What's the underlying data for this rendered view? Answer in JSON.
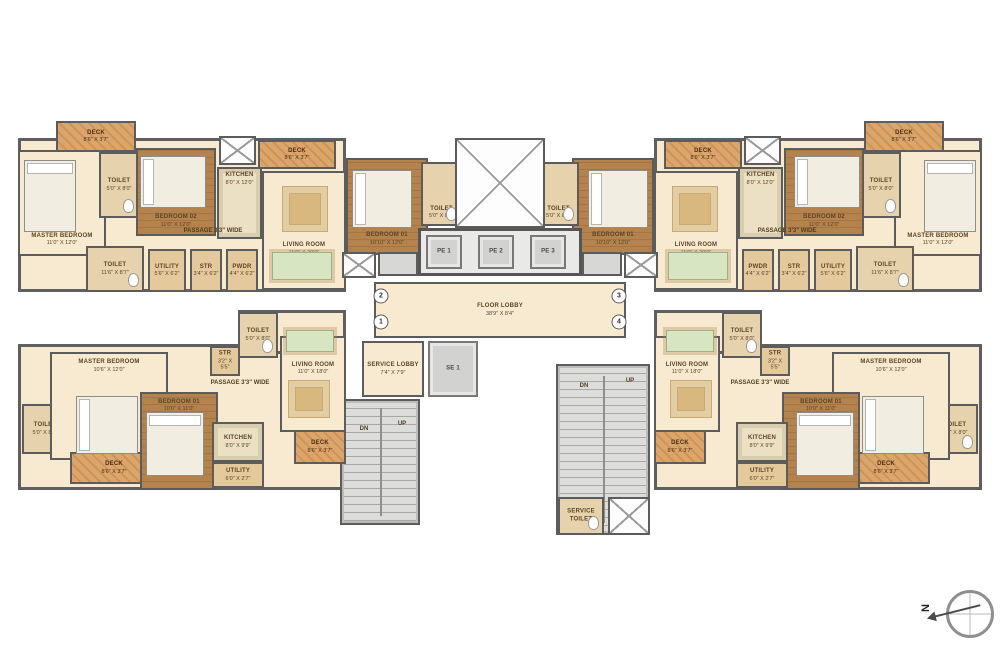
{
  "north": {
    "label": "N"
  },
  "colors": {
    "wall": "#5c5c5c",
    "floor_cream": "#f7ead0",
    "floor_wood": "#b3824d",
    "deck": "#dba56e",
    "kitchen": "#ece0c4",
    "toilet": "#e6d2ac",
    "utility": "#e4c99c",
    "stairs_gray": "#d7d7d5",
    "label_text": "#5e4526"
  },
  "rooms": [
    {
      "id": "unit-top-footprint",
      "label": "",
      "dims": "",
      "x": 18,
      "y": 138,
      "w": 328,
      "h": 154,
      "type": "base",
      "mirror": true
    },
    {
      "id": "unit-bottom-footprint",
      "label": "",
      "dims": "",
      "x": 18,
      "y": 344,
      "w": 328,
      "h": 146,
      "type": "base",
      "mirror": true
    },
    {
      "id": "unit-bottom-ext",
      "label": "",
      "dims": "",
      "x": 238,
      "y": 310,
      "w": 108,
      "h": 44,
      "type": "base",
      "mirror": true
    },
    {
      "id": "deck-top-outer",
      "label": "DECK",
      "dims": "8'6\" X 3'7\"",
      "x": 56,
      "y": 121,
      "w": 80,
      "h": 31,
      "type": "deck",
      "lp": "mid",
      "mirror": true
    },
    {
      "id": "master-bedroom-top",
      "label": "MASTER BEDROOM",
      "dims": "11'0\" X 12'0\"",
      "x": 18,
      "y": 150,
      "w": 88,
      "h": 106,
      "type": "cream",
      "lp": "bot",
      "mirror": true
    },
    {
      "id": "toilet-master-top",
      "label": "TOILET",
      "dims": "5'0\" X 8'0\"",
      "x": 99,
      "y": 152,
      "w": 40,
      "h": 66,
      "type": "toilet",
      "lp": "mid",
      "mirror": true
    },
    {
      "id": "bedroom-02-top",
      "label": "BEDROOM 02",
      "dims": "11'0\" X 12'0\"",
      "x": 136,
      "y": 148,
      "w": 80,
      "h": 88,
      "type": "wood",
      "lp": "bot",
      "mirror": true
    },
    {
      "id": "duct-top",
      "label": "",
      "dims": "",
      "x": 219,
      "y": 136,
      "w": 37,
      "h": 29,
      "type": "shaft",
      "mirror": true
    },
    {
      "id": "kitchen-top",
      "label": "KITCHEN",
      "dims": "8'0\" X 12'0\"",
      "x": 217,
      "y": 167,
      "w": 45,
      "h": 72,
      "type": "kitchen",
      "lp": "top",
      "mirror": true
    },
    {
      "id": "deck-top-inner",
      "label": "DECK",
      "dims": "8'6\" X 3'7\"",
      "x": 258,
      "y": 140,
      "w": 78,
      "h": 29,
      "type": "deck",
      "lp": "mid",
      "mirror": true
    },
    {
      "id": "living-room-top",
      "label": "LIVING ROOM",
      "dims": "11'0\" X 20'0\"",
      "x": 262,
      "y": 171,
      "w": 84,
      "h": 119,
      "type": "cream",
      "lp": "bot2",
      "mirror": true
    },
    {
      "id": "toilet-common-top",
      "label": "TOILET",
      "dims": "11'6\" X 8'7\"",
      "x": 86,
      "y": 246,
      "w": 58,
      "h": 46,
      "type": "toilet",
      "lp": "mid",
      "mirror": true
    },
    {
      "id": "utility-top",
      "label": "UTILITY",
      "dims": "5'6\" X 6'2\"",
      "x": 148,
      "y": 249,
      "w": 38,
      "h": 43,
      "type": "util",
      "lp": "mid",
      "mirror": true
    },
    {
      "id": "str-top",
      "label": "STR",
      "dims": "3'4\" X 6'2\"",
      "x": 190,
      "y": 249,
      "w": 32,
      "h": 43,
      "type": "util",
      "lp": "mid",
      "mirror": true
    },
    {
      "id": "pwdr-top",
      "label": "PWDR",
      "dims": "4'4\" X 6'2\"",
      "x": 226,
      "y": 249,
      "w": 32,
      "h": 43,
      "type": "util",
      "lp": "mid",
      "mirror": true
    },
    {
      "id": "bedroom-01-top",
      "label": "BEDROOM 01",
      "dims": "10'10\" X 12'0\"",
      "x": 346,
      "y": 158,
      "w": 82,
      "h": 97,
      "type": "wood",
      "lp": "bot",
      "mirror": true
    },
    {
      "id": "toilet-01-top",
      "label": "TOILET",
      "dims": "5'0\" X 8'0\"",
      "x": 421,
      "y": 162,
      "w": 41,
      "h": 64,
      "type": "toilet",
      "lp": "bot",
      "mirror": true
    },
    {
      "id": "void-center",
      "label": "",
      "dims": "",
      "x": 455,
      "y": 138,
      "w": 90,
      "h": 90,
      "type": "shaft"
    },
    {
      "id": "elevator-bank",
      "label": "",
      "dims": "",
      "x": 418,
      "y": 228,
      "w": 164,
      "h": 48,
      "type": "bank"
    },
    {
      "id": "elevator-pe1",
      "label": "PE 1",
      "dims": "",
      "x": 426,
      "y": 235,
      "w": 36,
      "h": 34,
      "type": "lift",
      "lp": "mid"
    },
    {
      "id": "elevator-pe2",
      "label": "PE 2",
      "dims": "",
      "x": 478,
      "y": 235,
      "w": 36,
      "h": 34,
      "type": "lift",
      "lp": "mid"
    },
    {
      "id": "elevator-pe3",
      "label": "PE 3",
      "dims": "",
      "x": 530,
      "y": 235,
      "w": 36,
      "h": 34,
      "type": "lift",
      "lp": "mid"
    },
    {
      "id": "lift-lobby-strip",
      "label": "",
      "dims": "",
      "x": 378,
      "y": 252,
      "w": 40,
      "h": 24,
      "type": "gray",
      "mirror": true
    },
    {
      "id": "shaft-near-stair-top",
      "label": "",
      "dims": "",
      "x": 342,
      "y": 252,
      "w": 34,
      "h": 26,
      "type": "shaft",
      "mirror": true
    },
    {
      "id": "floor-lobby",
      "label": "FLOOR LOBBY",
      "dims": "38'9\" X 8'4\"",
      "x": 374,
      "y": 282,
      "w": 252,
      "h": 56,
      "type": "cream",
      "lp": "mid"
    },
    {
      "id": "service-lobby",
      "label": "SERVICE LOBBY",
      "dims": "7'4\" X 7'9\"",
      "x": 362,
      "y": 341,
      "w": 62,
      "h": 56,
      "type": "cream",
      "lp": "mid"
    },
    {
      "id": "elevator-se1",
      "label": "SE 1",
      "dims": "",
      "x": 428,
      "y": 341,
      "w": 50,
      "h": 56,
      "type": "lift",
      "lp": "mid"
    },
    {
      "id": "stair-left",
      "label": "",
      "dims": "",
      "x": 340,
      "y": 399,
      "w": 80,
      "h": 126,
      "type": "stairs"
    },
    {
      "id": "stair-right",
      "label": "",
      "dims": "",
      "x": 556,
      "y": 364,
      "w": 94,
      "h": 171,
      "type": "stairs"
    },
    {
      "id": "service-toilet",
      "label": "SERVICE TOILET",
      "dims": "",
      "x": 558,
      "y": 497,
      "w": 46,
      "h": 38,
      "type": "toilet",
      "lp": "mid"
    },
    {
      "id": "shaft-bottom-right",
      "label": "",
      "dims": "",
      "x": 608,
      "y": 497,
      "w": 42,
      "h": 38,
      "type": "shaft"
    },
    {
      "id": "toilet-master-bottom",
      "label": "TOILET",
      "dims": "5'0\" X 8'0\"",
      "x": 22,
      "y": 404,
      "w": 46,
      "h": 50,
      "type": "toilet",
      "lp": "mid",
      "mirror": true
    },
    {
      "id": "master-bedroom-bottom",
      "label": "MASTER BEDROOM",
      "dims": "10'6\" X 12'0\"",
      "x": 50,
      "y": 352,
      "w": 118,
      "h": 108,
      "type": "cream",
      "lp": "top",
      "mirror": true
    },
    {
      "id": "deck-bottom-outer",
      "label": "DECK",
      "dims": "8'6\" X 3'7\"",
      "x": 70,
      "y": 452,
      "w": 88,
      "h": 32,
      "type": "deck",
      "lp": "mid",
      "mirror": true
    },
    {
      "id": "bedroom-01-bottom",
      "label": "BEDROOM 01",
      "dims": "10'0\" X 11'0\"",
      "x": 140,
      "y": 392,
      "w": 78,
      "h": 98,
      "type": "wood",
      "lp": "top",
      "mirror": true
    },
    {
      "id": "str-bottom",
      "label": "STR",
      "dims": "3'2\" X 5'5\"",
      "x": 210,
      "y": 346,
      "w": 30,
      "h": 30,
      "type": "util",
      "lp": "mid",
      "mirror": true
    },
    {
      "id": "toilet-common-bottom",
      "label": "TOILET",
      "dims": "5'0\" X 8'0\"",
      "x": 238,
      "y": 312,
      "w": 40,
      "h": 46,
      "type": "toilet",
      "lp": "mid",
      "mirror": true
    },
    {
      "id": "kitchen-bottom",
      "label": "KITCHEN",
      "dims": "8'0\" X 9'9\"",
      "x": 212,
      "y": 422,
      "w": 52,
      "h": 40,
      "type": "kitchen",
      "lp": "mid",
      "mirror": true
    },
    {
      "id": "utility-bottom",
      "label": "UTILITY",
      "dims": "6'0\" X 2'7\"",
      "x": 212,
      "y": 462,
      "w": 52,
      "h": 26,
      "type": "util",
      "lp": "mid",
      "mirror": true
    },
    {
      "id": "living-room-bottom",
      "label": "LIVING ROOM",
      "dims": "11'0\" X 18'0\"",
      "x": 280,
      "y": 336,
      "w": 66,
      "h": 96,
      "type": "cream",
      "lp": "mid2",
      "mirror": true
    },
    {
      "id": "deck-bottom-inner",
      "label": "DECK",
      "dims": "8'6\" X 3'7\"",
      "x": 294,
      "y": 430,
      "w": 52,
      "h": 34,
      "type": "deck",
      "lp": "mid",
      "mirror": true
    }
  ],
  "furniture": [
    {
      "id": "bed-master-top",
      "x": 24,
      "y": 160,
      "w": 52,
      "h": 72,
      "type": "bed",
      "mirror": true
    },
    {
      "id": "bed-bedroom02-top",
      "x": 140,
      "y": 156,
      "w": 66,
      "h": 52,
      "type": "bed-h",
      "mirror": true
    },
    {
      "id": "bed-bedroom01-top",
      "x": 352,
      "y": 170,
      "w": 60,
      "h": 58,
      "type": "bed-h",
      "mirror": true
    },
    {
      "id": "bed-master-bottom",
      "x": 76,
      "y": 396,
      "w": 62,
      "h": 58,
      "type": "bed-h",
      "mirror": true
    },
    {
      "id": "bed-bedroom01-bottom",
      "x": 146,
      "y": 412,
      "w": 58,
      "h": 64,
      "type": "bed",
      "mirror": true
    },
    {
      "id": "rug-living-top",
      "x": 282,
      "y": 186,
      "w": 46,
      "h": 46,
      "type": "rug",
      "mirror": true
    },
    {
      "id": "dining-table-top",
      "x": 272,
      "y": 252,
      "w": 60,
      "h": 28,
      "type": "table",
      "mirror": true
    },
    {
      "id": "rug-living-bottom",
      "x": 288,
      "y": 380,
      "w": 42,
      "h": 38,
      "type": "rug",
      "mirror": true
    },
    {
      "id": "dining-table-bottom",
      "x": 286,
      "y": 330,
      "w": 48,
      "h": 22,
      "type": "table",
      "mirror": true
    }
  ],
  "marks": [
    {
      "id": "passage-label-top",
      "t": "PASSAGE 3'3\" WIDE",
      "x": 213,
      "y": 231,
      "mirror": true
    },
    {
      "id": "passage-label-bottom",
      "t": "PASSAGE 3'3\" WIDE",
      "x": 240,
      "y": 383,
      "mirror": true
    },
    {
      "id": "stair-left-dn-label",
      "t": "DN",
      "x": 364,
      "y": 429
    },
    {
      "id": "stair-left-up-label",
      "t": "UP",
      "x": 402,
      "y": 424
    },
    {
      "id": "stair-right-dn-label",
      "t": "DN",
      "x": 584,
      "y": 386
    },
    {
      "id": "stair-right-up-label",
      "t": "UP",
      "x": 630,
      "y": 381
    },
    {
      "id": "unit-number-2",
      "t": "2",
      "x": 381,
      "y": 296,
      "circle": true
    },
    {
      "id": "unit-number-1",
      "t": "1",
      "x": 381,
      "y": 322,
      "circle": true
    },
    {
      "id": "unit-number-3",
      "t": "3",
      "x": 619,
      "y": 296,
      "circle": true
    },
    {
      "id": "unit-number-4",
      "t": "4",
      "x": 619,
      "y": 322,
      "circle": true
    }
  ]
}
